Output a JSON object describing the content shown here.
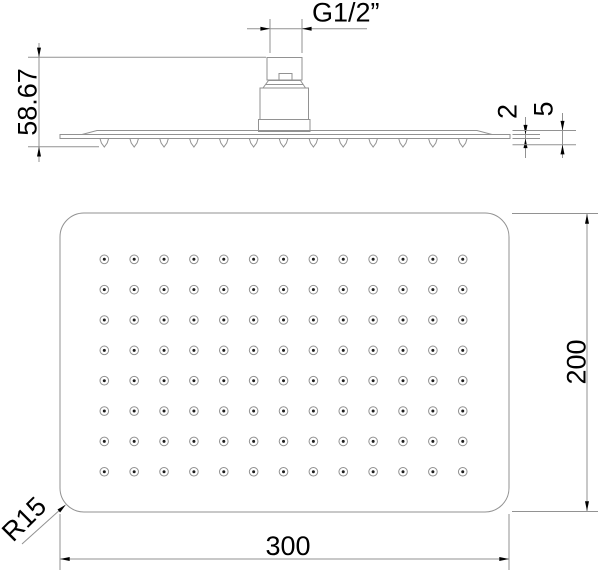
{
  "colors": {
    "line": "#929292",
    "ink": "#000000",
    "background": "#ffffff",
    "nozzle_dot": "#1c1c1c"
  },
  "side_view": {
    "name": "side elevation",
    "thread_label": "G1/2”",
    "height_label": "58.67",
    "edge_thickness_label": "2",
    "overall_thickness_label": "5",
    "nozzle_count": 13
  },
  "face_view": {
    "name": "face view",
    "width_label": "300",
    "height_label": "200",
    "corner_radius_label": "R15",
    "nozzle_grid": {
      "cols": 13,
      "rows": 8
    }
  }
}
